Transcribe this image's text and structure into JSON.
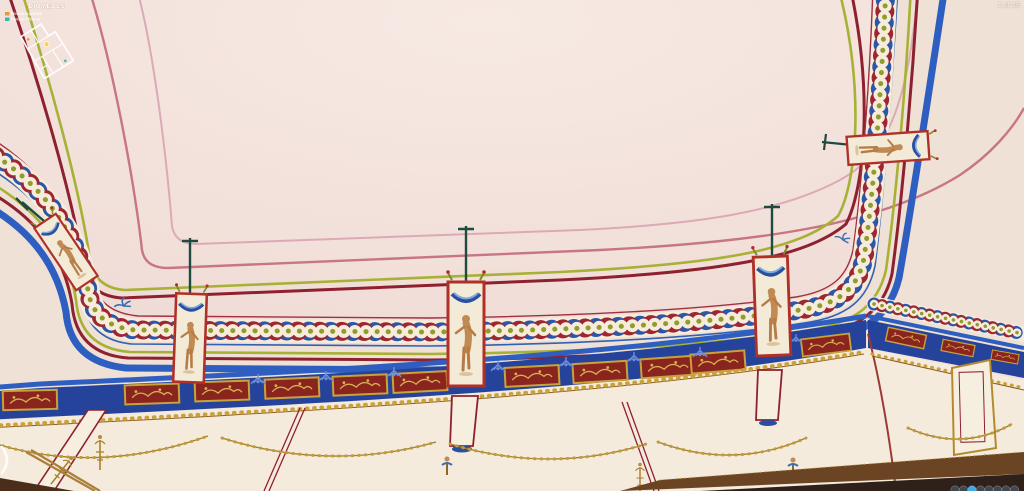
{
  "viewer": {
    "scene_counter": "1 of 15"
  },
  "minimap": {
    "title": "DIOMEDES",
    "position_marker_color": "#ffd23e",
    "legend": [
      {
        "label": "Niveau superieur",
        "color": "#e09c3a"
      },
      {
        "label": "Niveau inferieur",
        "color": "#38b8a8"
      }
    ]
  },
  "nav": {
    "prev_icon": "chevron-left-arc"
  },
  "controls": {
    "buttons": [
      {
        "name": "zoom-in",
        "color": "#3f4750"
      },
      {
        "name": "zoom-out",
        "color": "#3f4750"
      },
      {
        "name": "autorotate",
        "color": "#3ea7e6"
      },
      {
        "name": "gyroscope",
        "color": "#3f4750"
      },
      {
        "name": "vr-mode",
        "color": "#3f4750"
      },
      {
        "name": "hotspot-list",
        "color": "#3f4750"
      },
      {
        "name": "share",
        "color": "#3f4750"
      },
      {
        "name": "fullscreen",
        "color": "#3f4750"
      }
    ],
    "active_index": 2,
    "active_color": "#3ea7e6",
    "inactive_color": "#3f4750"
  },
  "scene": {
    "subject": "Reconstructed painted coved ceiling and upper wall frieze, Roman villa panorama",
    "colors": {
      "ceiling_cream": "#f2e0da",
      "cove_cream": "#efe1d5",
      "wall_cream": "#f5ebdc",
      "maroon": "#8e2130",
      "olive": "#a7b135",
      "blue_band": "#2e5fc0",
      "frieze_blue": "#26439b",
      "panel_red": "#8a241f",
      "gold": "#c9a23a",
      "rose": "#c87584",
      "pink": "#dcaab6",
      "figure_tan": "#c08a52",
      "stem_teal": "#1e4a40",
      "wood_brown": "#6b4423"
    }
  }
}
